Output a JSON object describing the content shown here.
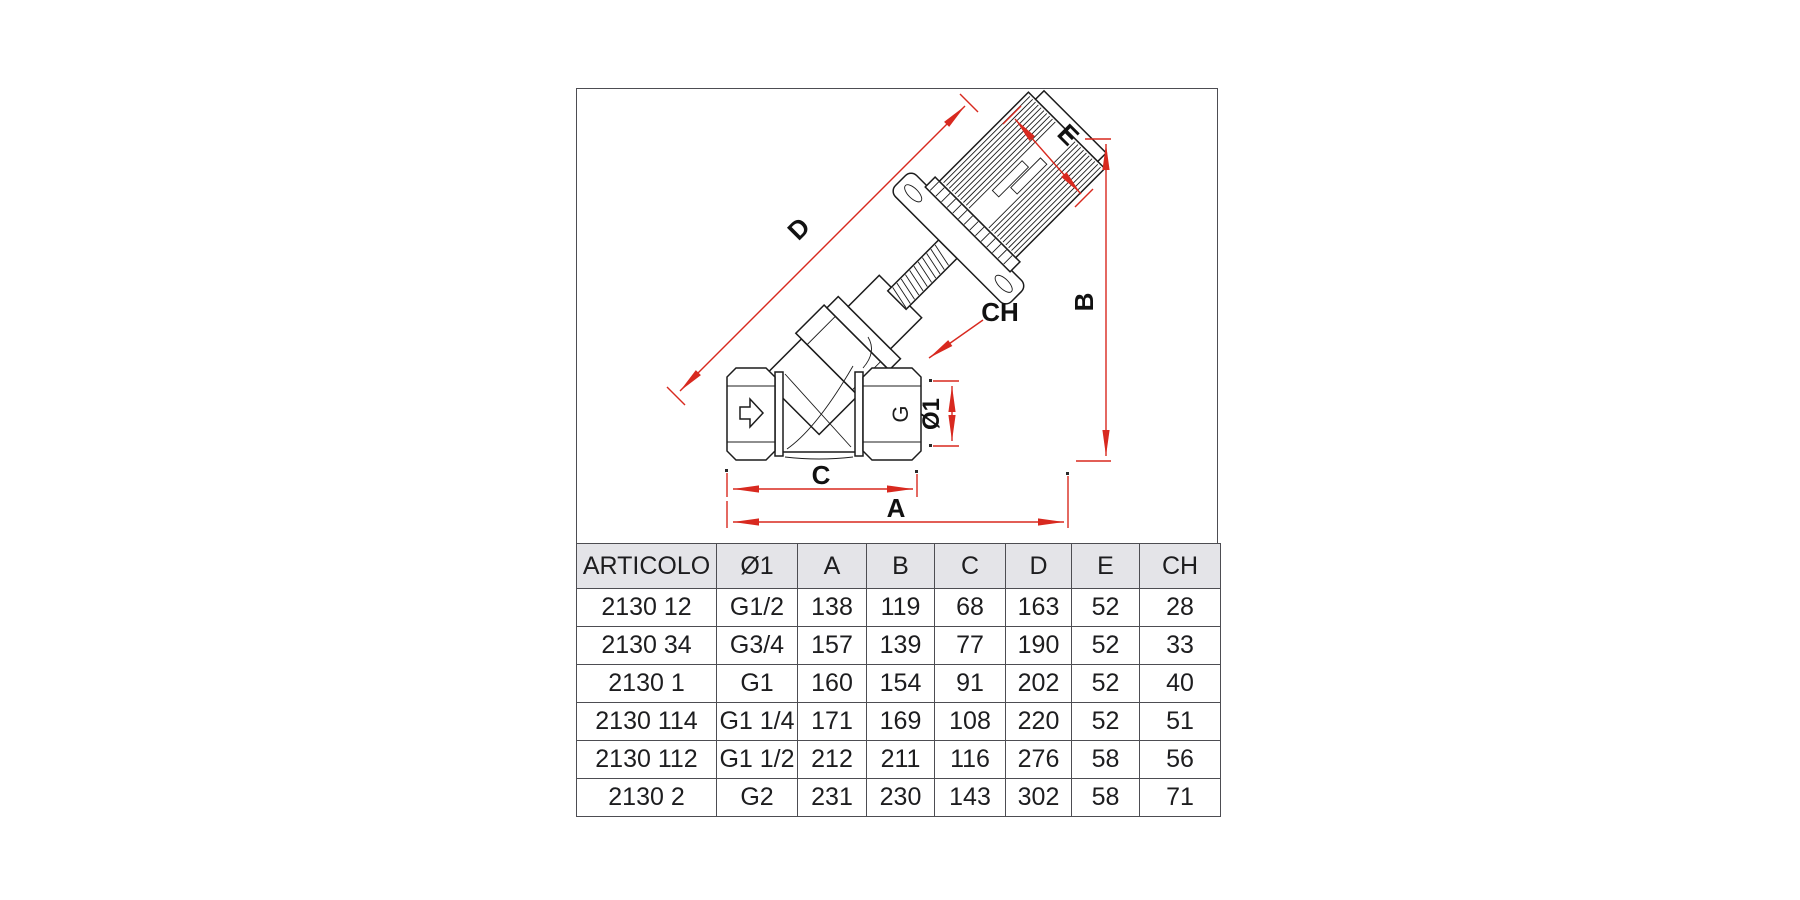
{
  "figure": {
    "dimension_labels": {
      "D": "D",
      "E": "E",
      "B": "B",
      "CH": "CH",
      "dia1": "Ø1",
      "C": "C",
      "A": "A"
    },
    "valve_markings": {
      "body_mark": "G"
    },
    "icons": {
      "flow_direction": "right-arrow-icon"
    }
  },
  "table": {
    "headers": [
      "ARTICOLO",
      "Ø1",
      "A",
      "B",
      "C",
      "D",
      "E",
      "CH"
    ],
    "rows": [
      [
        "2130 12",
        "G1/2",
        "138",
        "119",
        "68",
        "163",
        "52",
        "28"
      ],
      [
        "2130 34",
        "G3/4",
        "157",
        "139",
        "77",
        "190",
        "52",
        "33"
      ],
      [
        "2130 1",
        "G1",
        "160",
        "154",
        "91",
        "202",
        "52",
        "40"
      ],
      [
        "2130 114",
        "G1 1/4",
        "171",
        "169",
        "108",
        "220",
        "52",
        "51"
      ],
      [
        "2130 112",
        "G1 1/2",
        "212",
        "211",
        "116",
        "276",
        "58",
        "56"
      ],
      [
        "2130 2",
        "G2",
        "231",
        "230",
        "143",
        "302",
        "58",
        "71"
      ]
    ]
  },
  "colors": {
    "dimension_red": "#d8291f",
    "drawing_black": "#1c1c1c",
    "table_border": "#4d4d52",
    "header_bg": "#e4e4e8"
  }
}
